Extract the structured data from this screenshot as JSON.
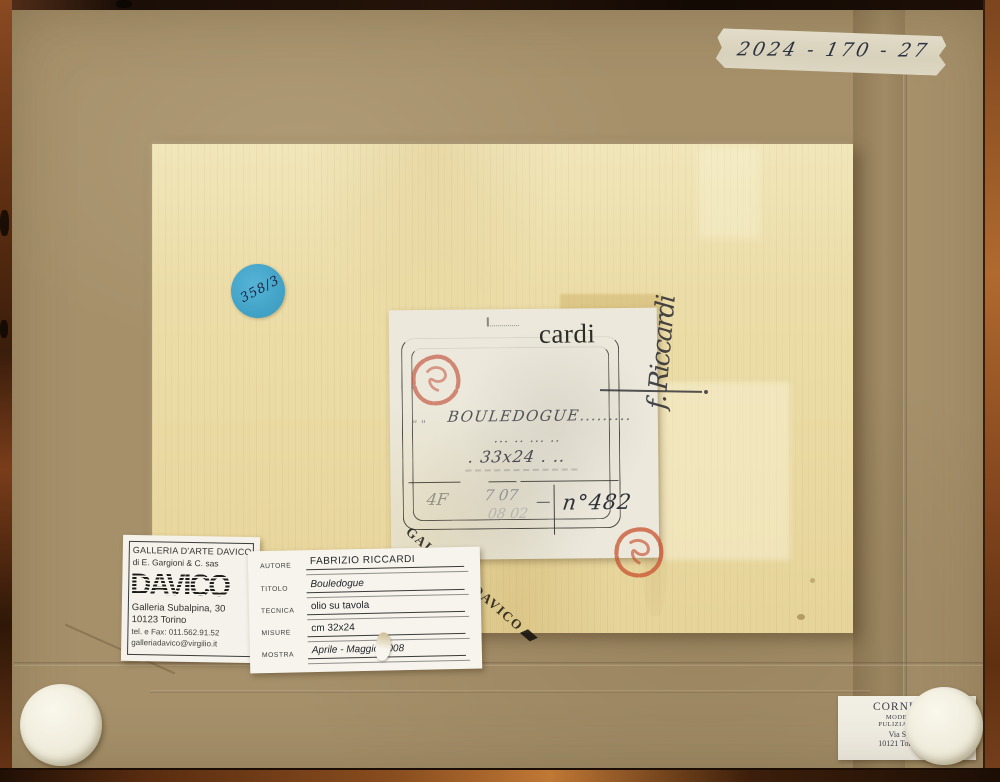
{
  "tape": {
    "text": "2024 - 170 - 27"
  },
  "sticker": {
    "text": "358/3"
  },
  "signature": {
    "text": "f. Riccardi"
  },
  "center_label": {
    "letterhead": "cardi",
    "title": "BOULEDOGUE",
    "title_dots": ".........",
    "dots": "... .. ... ..",
    "size_pre": ". ",
    "size": "33x24",
    "size_post": " . ..",
    "code1": "4F",
    "code2": "7 07",
    "code3": "08 02",
    "number": "n°482",
    "stamp": "GALLERIA DAVICO"
  },
  "gallery_label": {
    "name": "GALLERIA D'ARTE DAVICO",
    "subname": "di E. Gargioni & C. sas",
    "logo": "DAVICO",
    "address1": "Galleria Subalpina, 30",
    "address2": "10123 Torino",
    "phone": "tel. e Fax: 011.562.91.52",
    "email": "galleriadavico@virgilio.it"
  },
  "artwork_label": {
    "rows": [
      {
        "label": "AUTORE",
        "value": "FABRIZIO RICCARDI"
      },
      {
        "label": "TITOLO",
        "value": "Bouledogue"
      },
      {
        "label": "TECNICA",
        "value": "olio su tavola"
      },
      {
        "label": "MISURE",
        "value": "cm 32x24"
      },
      {
        "label": "MOSTRA",
        "value": "Aprile - Maggio 2008"
      }
    ]
  },
  "framer_label": {
    "line1": "CORNICI &",
    "line2": "MODERNE E",
    "line3": "PULIZIA DIPINTI",
    "line4": "Via San Qu",
    "line5": "10121 Torino - Te"
  },
  "colors": {
    "cardboard": "#a5906a",
    "panel": "#eadca4",
    "sticker_blue": "#3f9fc4",
    "stamp_red": "#c0452f"
  }
}
